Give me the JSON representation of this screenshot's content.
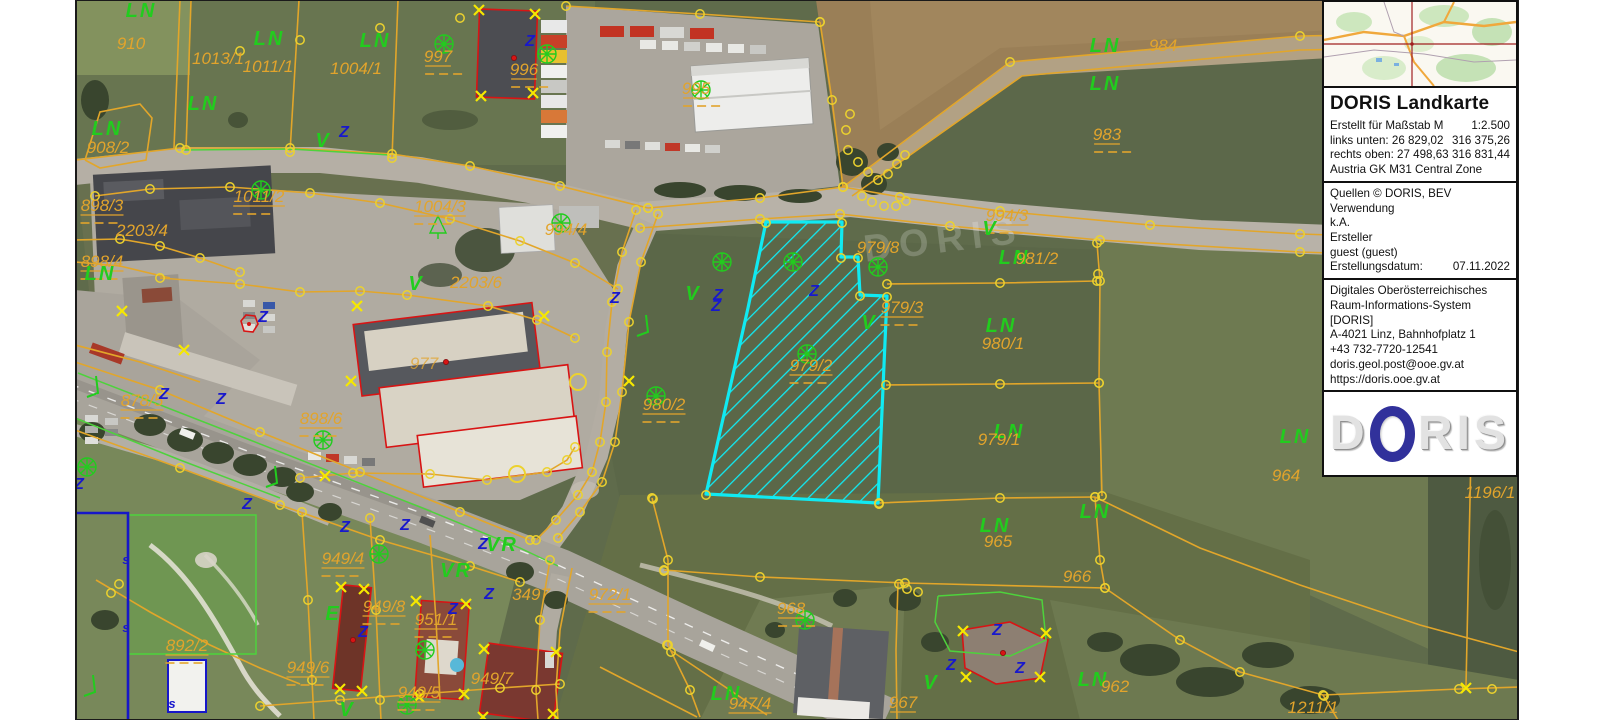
{
  "app": {
    "title": "DORIS Landkarte"
  },
  "panel": {
    "title": "DORIS Landkarte",
    "scale_label": "Erstellt für Maßstab M",
    "scale_value": "1:2.500",
    "links_label": "links unten: 26 829,02",
    "links_value": "316 375,26",
    "rechts_label": "rechts oben: 27 498,63",
    "rechts_value": "316 831,44",
    "zone": "Austria GK M31 Central Zone",
    "quellen": "Quellen © DORIS, BEV",
    "verwendung_label": "Verwendung",
    "verwendung_value": "k.A.",
    "ersteller_label": "Ersteller",
    "ersteller_value": "guest (guest)",
    "datum_label": "Erstellungsdatum:",
    "datum_value": "07.11.2022",
    "org1": "Digitales Oberösterreichisches",
    "org2": "Raum-Informations-System [DORIS]",
    "org3": "A-4021 Linz, Bahnhofplatz 1",
    "org4": "+43 732-7720-12541",
    "org5": "doris.geol.post@ooe.gv.at",
    "org6": "https://doris.ooe.gv.at",
    "logo_d": "D",
    "logo_ris": "RIS"
  },
  "map": {
    "highlighted_parcel": "979/2",
    "watermark": "DORIS",
    "colors": {
      "boundary": "#e2a62a",
      "vertex": "#ecd22e",
      "xmark": "#f6e800",
      "label_orange": "#e2a42c",
      "label_green": "#22cc1e",
      "label_blue": "#1818cc",
      "highlight": "#10eaf2",
      "building_outline": "#d81414",
      "admin_blue": "#1717c8"
    },
    "labels": [
      {
        "t": "LN",
        "x": 141,
        "y": 17,
        "c": "g"
      },
      {
        "t": "910",
        "x": 131,
        "y": 49,
        "c": "o"
      },
      {
        "t": "LN",
        "x": 269,
        "y": 45,
        "c": "g"
      },
      {
        "t": "LN",
        "x": 375,
        "y": 47,
        "c": "g"
      },
      {
        "t": "1013/1",
        "x": 218,
        "y": 64,
        "c": "o"
      },
      {
        "t": "1011/1",
        "x": 268,
        "y": 72,
        "c": "o"
      },
      {
        "t": "1004/1",
        "x": 356,
        "y": 74,
        "c": "o"
      },
      {
        "t": "997",
        "x": 438,
        "y": 62,
        "c": "o",
        "u": 1
      },
      {
        "t": "996",
        "x": 524,
        "y": 75,
        "c": "o",
        "u": 1
      },
      {
        "t": "995",
        "x": 696,
        "y": 94,
        "c": "o",
        "u": 1
      },
      {
        "t": "LN",
        "x": 1105,
        "y": 52,
        "c": "g"
      },
      {
        "t": "984",
        "x": 1163,
        "y": 51,
        "c": "o"
      },
      {
        "t": "LN",
        "x": 1105,
        "y": 90,
        "c": "g"
      },
      {
        "t": "983",
        "x": 1107,
        "y": 140,
        "c": "o",
        "u": 1
      },
      {
        "t": "LN",
        "x": 203,
        "y": 110,
        "c": "g"
      },
      {
        "t": "LN",
        "x": 107,
        "y": 135,
        "c": "g"
      },
      {
        "t": "908/2",
        "x": 108,
        "y": 153,
        "c": "o"
      },
      {
        "t": "898/3",
        "x": 102,
        "y": 211,
        "c": "o",
        "u": 1
      },
      {
        "t": "2203/4",
        "x": 142,
        "y": 236,
        "c": "o"
      },
      {
        "t": "898/4",
        "x": 102,
        "y": 267,
        "c": "o",
        "u": 1
      },
      {
        "t": "LN",
        "x": 100,
        "y": 280,
        "c": "g"
      },
      {
        "t": "1011/2",
        "x": 259,
        "y": 202,
        "c": "o",
        "u": 1
      },
      {
        "t": "1004/3",
        "x": 440,
        "y": 212,
        "c": "o",
        "u": 1
      },
      {
        "t": "994/4",
        "x": 566,
        "y": 235,
        "c": "o"
      },
      {
        "t": "2203/6",
        "x": 476,
        "y": 288,
        "c": "o"
      },
      {
        "t": "V",
        "x": 416,
        "y": 290,
        "c": "g"
      },
      {
        "t": "V",
        "x": 323,
        "y": 147,
        "c": "g"
      },
      {
        "t": "Z",
        "x": 344,
        "y": 137,
        "c": "b"
      },
      {
        "t": "977",
        "x": 424,
        "y": 369,
        "c": "o",
        "f": 1
      },
      {
        "t": "898/6",
        "x": 321,
        "y": 424,
        "c": "o",
        "u": 1
      },
      {
        "t": "878/5",
        "x": 142,
        "y": 406,
        "c": "o",
        "u": 1
      },
      {
        "t": "994/3",
        "x": 1007,
        "y": 221,
        "c": "o",
        "u": 1
      },
      {
        "t": "V",
        "x": 990,
        "y": 235,
        "c": "g"
      },
      {
        "t": "979/8",
        "x": 878,
        "y": 253,
        "c": "o"
      },
      {
        "t": "LN",
        "x": 1014,
        "y": 264,
        "c": "g"
      },
      {
        "t": "981/2",
        "x": 1037,
        "y": 264,
        "c": "o"
      },
      {
        "t": "979/3",
        "x": 902,
        "y": 313,
        "c": "o",
        "u": 1
      },
      {
        "t": "V",
        "x": 869,
        "y": 329,
        "c": "g"
      },
      {
        "t": "979/2",
        "x": 811,
        "y": 371,
        "c": "o",
        "u": 1
      },
      {
        "t": "980/2",
        "x": 664,
        "y": 410,
        "c": "o",
        "u": 1
      },
      {
        "t": "LN",
        "x": 1001,
        "y": 332,
        "c": "g"
      },
      {
        "t": "980/1",
        "x": 1003,
        "y": 349,
        "c": "o"
      },
      {
        "t": "LN",
        "x": 1009,
        "y": 438,
        "c": "g"
      },
      {
        "t": "979/1",
        "x": 999,
        "y": 445,
        "c": "o"
      },
      {
        "t": "LN",
        "x": 1295,
        "y": 443,
        "c": "g"
      },
      {
        "t": "964",
        "x": 1286,
        "y": 481,
        "c": "o"
      },
      {
        "t": "1196/1",
        "x": 1490,
        "y": 498,
        "c": "o"
      },
      {
        "t": "LN",
        "x": 995,
        "y": 532,
        "c": "g"
      },
      {
        "t": "965",
        "x": 998,
        "y": 547,
        "c": "o"
      },
      {
        "t": "LN",
        "x": 1095,
        "y": 518,
        "c": "g"
      },
      {
        "t": "966",
        "x": 1077,
        "y": 582,
        "c": "o"
      },
      {
        "t": "968",
        "x": 791,
        "y": 614,
        "c": "o",
        "u": 1
      },
      {
        "t": "V",
        "x": 693,
        "y": 300,
        "c": "g"
      },
      {
        "t": "Z",
        "x": 718,
        "y": 300,
        "c": "b"
      },
      {
        "t": "Z",
        "x": 716,
        "y": 311,
        "c": "b"
      },
      {
        "t": "Z",
        "x": 814,
        "y": 296,
        "c": "b"
      },
      {
        "t": "LN",
        "x": 1093,
        "y": 686,
        "c": "g"
      },
      {
        "t": "962",
        "x": 1115,
        "y": 692,
        "c": "o"
      },
      {
        "t": "1211/1",
        "x": 1313,
        "y": 713,
        "c": "o"
      },
      {
        "t": "LN",
        "x": 726,
        "y": 700,
        "c": "g"
      },
      {
        "t": "947/4",
        "x": 750,
        "y": 709,
        "c": "o",
        "u": 1
      },
      {
        "t": "967",
        "x": 903,
        "y": 708,
        "c": "o",
        "u": 1
      },
      {
        "t": "V",
        "x": 931,
        "y": 689,
        "c": "g"
      },
      {
        "t": "Z",
        "x": 997,
        "y": 635,
        "c": "b"
      },
      {
        "t": "Z",
        "x": 1020,
        "y": 673,
        "c": "b"
      },
      {
        "t": "Z",
        "x": 951,
        "y": 670,
        "c": "b"
      },
      {
        "t": "972/1",
        "x": 610,
        "y": 600,
        "c": "o",
        "u": 1
      },
      {
        "t": "3497",
        "x": 531,
        "y": 600,
        "c": "o"
      },
      {
        "t": "VR",
        "x": 502,
        "y": 551,
        "c": "g"
      },
      {
        "t": "VR",
        "x": 456,
        "y": 577,
        "c": "g"
      },
      {
        "t": "949/4",
        "x": 343,
        "y": 564,
        "c": "o",
        "u": 1
      },
      {
        "t": "949/8",
        "x": 384,
        "y": 612,
        "c": "o",
        "u": 1
      },
      {
        "t": "951/1",
        "x": 436,
        "y": 625,
        "c": "o",
        "u": 1
      },
      {
        "t": "E",
        "x": 333,
        "y": 620,
        "c": "g"
      },
      {
        "t": "949/6",
        "x": 308,
        "y": 673,
        "c": "o",
        "u": 1
      },
      {
        "t": "949/7",
        "x": 492,
        "y": 684,
        "c": "o"
      },
      {
        "t": "949/5",
        "x": 419,
        "y": 698,
        "c": "o",
        "u": 1
      },
      {
        "t": "892/2",
        "x": 187,
        "y": 651,
        "c": "o",
        "u": 1
      },
      {
        "t": "V",
        "x": 347,
        "y": 716,
        "c": "g"
      },
      {
        "t": "Z",
        "x": 530,
        "y": 46,
        "c": "b"
      },
      {
        "t": "Z",
        "x": 615,
        "y": 303,
        "c": "b"
      },
      {
        "t": "Z",
        "x": 164,
        "y": 399,
        "c": "b"
      },
      {
        "t": "Z",
        "x": 221,
        "y": 404,
        "c": "b"
      },
      {
        "t": "Z",
        "x": 79,
        "y": 489,
        "c": "b"
      },
      {
        "t": "Z",
        "x": 247,
        "y": 509,
        "c": "b"
      },
      {
        "t": "Z",
        "x": 345,
        "y": 532,
        "c": "b"
      },
      {
        "t": "Z",
        "x": 405,
        "y": 530,
        "c": "b"
      },
      {
        "t": "Z",
        "x": 483,
        "y": 549,
        "c": "b"
      },
      {
        "t": "Z",
        "x": 489,
        "y": 599,
        "c": "b"
      },
      {
        "t": "Z",
        "x": 453,
        "y": 614,
        "c": "b"
      },
      {
        "t": "Z",
        "x": 363,
        "y": 637,
        "c": "b"
      },
      {
        "t": "Z",
        "x": 263,
        "y": 322,
        "c": "b"
      },
      {
        "t": "s",
        "x": 126,
        "y": 564,
        "c": "b",
        "sz": 13
      },
      {
        "t": "s",
        "x": 126,
        "y": 632,
        "c": "b",
        "sz": 13
      },
      {
        "t": "s",
        "x": 172,
        "y": 708,
        "c": "b",
        "sz": 13
      }
    ],
    "symbols": [
      {
        "k": "tree",
        "x": 444,
        "y": 44
      },
      {
        "k": "tree",
        "x": 547,
        "y": 54
      },
      {
        "k": "tree",
        "x": 701,
        "y": 90
      },
      {
        "k": "tree",
        "x": 261,
        "y": 190
      },
      {
        "k": "tree",
        "x": 561,
        "y": 223
      },
      {
        "k": "tree",
        "x": 878,
        "y": 267
      },
      {
        "k": "tree",
        "x": 807,
        "y": 354
      },
      {
        "k": "tree",
        "x": 722,
        "y": 262
      },
      {
        "k": "tree",
        "x": 793,
        "y": 262
      },
      {
        "k": "tree",
        "x": 656,
        "y": 396
      },
      {
        "k": "tree",
        "x": 805,
        "y": 620
      },
      {
        "k": "tree",
        "x": 379,
        "y": 554
      },
      {
        "k": "tree",
        "x": 425,
        "y": 650
      },
      {
        "k": "tree",
        "x": 407,
        "y": 705
      },
      {
        "k": "tree",
        "x": 87,
        "y": 467
      },
      {
        "k": "tree",
        "x": 323,
        "y": 440
      },
      {
        "k": "pine",
        "x": 438,
        "y": 226
      },
      {
        "k": "slope",
        "x": 95,
        "y": 391
      },
      {
        "k": "slope",
        "x": 274,
        "y": 481
      },
      {
        "k": "slope",
        "x": 92,
        "y": 690
      },
      {
        "k": "slope",
        "x": 645,
        "y": 330
      },
      {
        "k": "well",
        "x": 249,
        "y": 324
      },
      {
        "k": "dot",
        "x": 514,
        "y": 58
      },
      {
        "k": "dot",
        "x": 353,
        "y": 640
      },
      {
        "k": "dot",
        "x": 1003,
        "y": 653
      },
      {
        "k": "dot",
        "x": 446,
        "y": 362
      }
    ],
    "extra_circles": [
      [
        706,
        495
      ],
      [
        879,
        504
      ],
      [
        766,
        223
      ],
      [
        842,
        223
      ],
      [
        841,
        258
      ],
      [
        858,
        258
      ],
      [
        860,
        296
      ],
      [
        887,
        297
      ],
      [
        848,
        150
      ],
      [
        858,
        162
      ],
      [
        868,
        172
      ],
      [
        878,
        180
      ],
      [
        888,
        174
      ],
      [
        897,
        164
      ],
      [
        905,
        155
      ],
      [
        862,
        196
      ],
      [
        872,
        202
      ],
      [
        884,
        206
      ],
      [
        896,
        206
      ],
      [
        906,
        201
      ],
      [
        846,
        130
      ],
      [
        850,
        114
      ],
      [
        899,
        584
      ],
      [
        907,
        589
      ],
      [
        918,
        592
      ],
      [
        664,
        571
      ],
      [
        653,
        499
      ],
      [
        1324,
        696
      ],
      [
        1492,
        689
      ],
      [
        578,
        382,
        8
      ],
      [
        517,
        474,
        8
      ],
      [
        1098,
        274
      ],
      [
        667,
        645
      ],
      [
        671,
        652
      ],
      [
        119,
        584
      ],
      [
        111,
        593
      ],
      [
        240,
        51
      ],
      [
        300,
        40
      ],
      [
        380,
        28
      ],
      [
        460,
        18
      ]
    ],
    "x_marks": [
      [
        479,
        10
      ],
      [
        535,
        14
      ],
      [
        481,
        96
      ],
      [
        533,
        93
      ],
      [
        357,
        306
      ],
      [
        544,
        316
      ],
      [
        351,
        381
      ],
      [
        629,
        381
      ],
      [
        416,
        601
      ],
      [
        466,
        604
      ],
      [
        419,
        697
      ],
      [
        464,
        694
      ],
      [
        341,
        587
      ],
      [
        364,
        589
      ],
      [
        340,
        689
      ],
      [
        362,
        691
      ],
      [
        484,
        649
      ],
      [
        556,
        652
      ],
      [
        483,
        717
      ],
      [
        963,
        631
      ],
      [
        1046,
        633
      ],
      [
        1040,
        677
      ],
      [
        966,
        677
      ],
      [
        1466,
        688
      ],
      [
        122,
        311
      ],
      [
        184,
        350
      ],
      [
        325,
        476
      ],
      [
        553,
        714
      ]
    ]
  }
}
